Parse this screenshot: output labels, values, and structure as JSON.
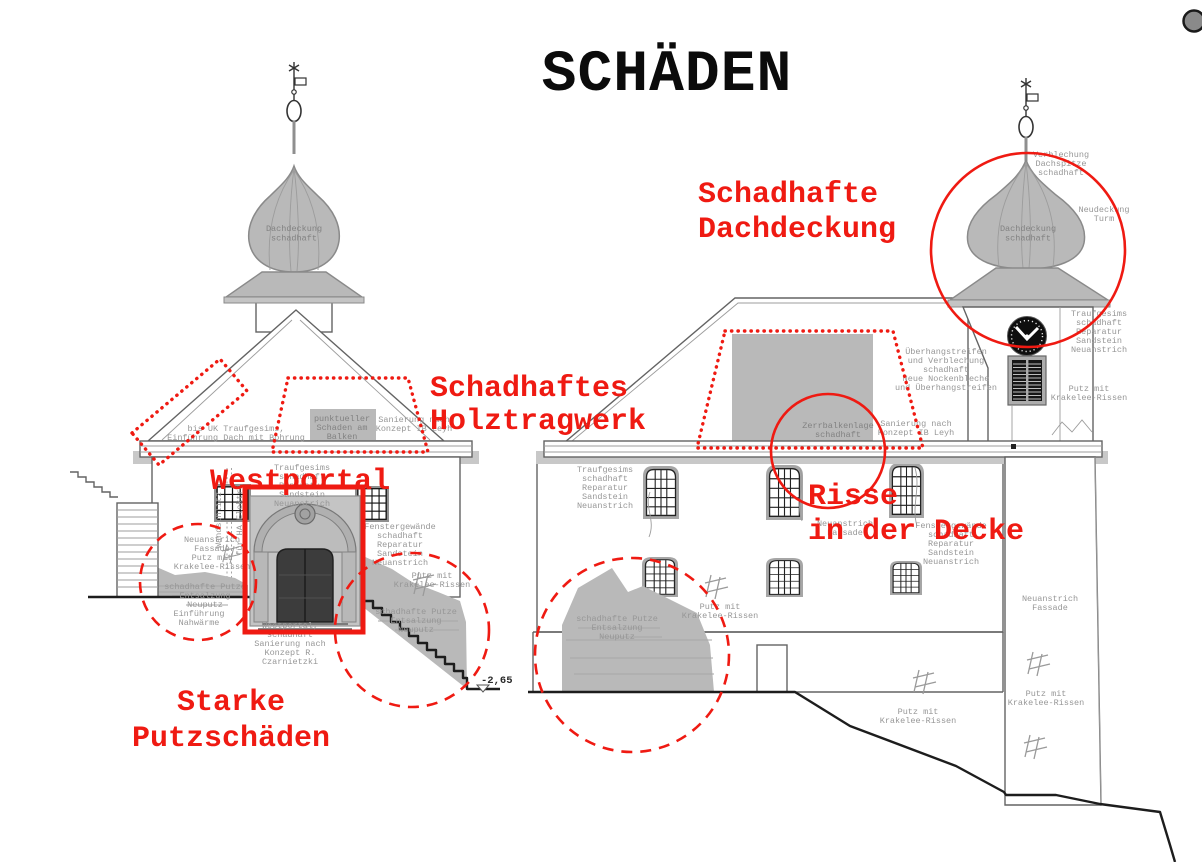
{
  "title": "SCHÄDEN",
  "colors": {
    "annotation_red": "#ef1a12",
    "drawing_gray": "#636363",
    "patch_gray": "#b9b9b9",
    "label_gray": "#979797",
    "corner_button_gray": "#8a8a8a"
  },
  "red": {
    "schadhafte_dachdeckung": {
      "lines": [
        "Schadhafte",
        "Dachdeckung"
      ]
    },
    "schadhaftes_holztragwerk": {
      "lines": [
        "Schadhaftes",
        "Holztragwerk"
      ]
    },
    "westportal": {
      "label": "Westportal"
    },
    "risse": {
      "lines": [
        "Risse",
        "in der Decke"
      ]
    },
    "starke_putzschaeden": {
      "lines": [
        "Starke",
        "Putzschäden"
      ]
    }
  },
  "labels": {
    "tower_left_dome": {
      "lines": [
        "Dachdeckung",
        "schadhaft"
      ]
    },
    "left_bis_uk": {
      "lines": [
        "bis UK Traufgesims,",
        "Einführung Dach mit Bohrung"
      ]
    },
    "left_punktuell": {
      "lines": [
        "punktueller",
        "Schaden am",
        "Balken"
      ]
    },
    "left_sanierung_leyh": {
      "lines": [
        "Sanierung nach",
        "Konzept IB Leyh"
      ]
    },
    "left_traufgesims": {
      "lines": [
        "Traufgesims",
        "schadhaft",
        "Reparatur",
        "Sandstein",
        "Neuanstrich"
      ]
    },
    "left_wandschlitz": {
      "label": "Wandschlitz"
    },
    "left_ha_elektro": {
      "label": "für HA Elektro"
    },
    "left_neuanstrich_fassade": {
      "lines": [
        "Neuanstrich",
        "Fassade",
        "Putz mit",
        "Krakelee-Rissen"
      ]
    },
    "left_schadhafte_putze_1": {
      "lines": [
        "schadhafte Putze",
        "Entsalzung",
        "Neuputz"
      ]
    },
    "left_einfuehrung_nahwaerme": {
      "lines": [
        "Einführung",
        "Nahwärme"
      ]
    },
    "left_westportal_schadhaft": {
      "lines": [
        "Westportal,",
        "schadhaft",
        "Sanierung nach",
        "Konzept R.",
        "Czarnietzki"
      ]
    },
    "left_fenstergewaende": {
      "lines": [
        "Fenstergewände",
        "schadhaft",
        "Reparatur",
        "Sandstein",
        "Neuanstrich"
      ]
    },
    "left_putz_krakelee": {
      "lines": [
        "Putz mit",
        "Krakelee-Rissen"
      ]
    },
    "left_schadhafte_putze_2": {
      "lines": [
        "schadhafte Putze",
        "Entsalzung",
        "Neuputz"
      ]
    },
    "right_traufgesims_1": {
      "lines": [
        "Traufgesims",
        "schadhaft",
        "Reparatur",
        "Sandstein",
        "Neuanstrich"
      ]
    },
    "right_zerrbalken": {
      "lines": [
        "Zerrbalkenlage",
        "schadhaft"
      ]
    },
    "right_sanierung_leyh": {
      "lines": [
        "Sanierung nach",
        "Konzept IB Leyh"
      ]
    },
    "right_ueberhang": {
      "lines": [
        "Überhangstreifen",
        "und Verblechung",
        "schadhaft",
        "Neue Nockenbleche",
        "und Überhangstreifen"
      ]
    },
    "right_neuanstrich_mid": {
      "lines": [
        "Neuanstrich",
        "Fassade"
      ]
    },
    "right_fenstergewaende": {
      "lines": [
        "Fenstergewände",
        "schadhaft",
        "Reparatur",
        "Sandstein",
        "Neuanstrich"
      ]
    },
    "right_putz_krakelee_1": {
      "lines": [
        "Putz mit",
        "Krakelee-Rissen"
      ]
    },
    "right_schadhafte_putze": {
      "lines": [
        "schadhafte Putze",
        "Entsalzung",
        "Neuputz"
      ]
    },
    "right_putz_krakelee_2": {
      "lines": [
        "Putz mit",
        "Krakelee-Rissen"
      ]
    },
    "tower_right_verblechung": {
      "lines": [
        "Verblechung",
        "Dachspitze",
        "schadhaft"
      ]
    },
    "tower_right_neudeckung": {
      "lines": [
        "Neudeckung",
        "Turm"
      ]
    },
    "tower_right_dome": {
      "lines": [
        "Dachdeckung",
        "schadhaft"
      ]
    },
    "tower_right_traufgesims": {
      "lines": [
        "Traufgesims",
        "schadhaft",
        "Reparatur",
        "Sandstein",
        "Neuanstrich"
      ]
    },
    "tower_right_putz_krakelee_top": {
      "lines": [
        "Putz mit",
        "Krakelee-Rissen"
      ]
    },
    "tower_right_neuanstrich": {
      "lines": [
        "Neuanstrich",
        "Fassade"
      ]
    },
    "tower_right_putz_krakelee_mid": {
      "lines": [
        "Putz mit",
        "Krakelee-Rissen"
      ]
    }
  },
  "level_marker": {
    "label": "-2,65"
  }
}
